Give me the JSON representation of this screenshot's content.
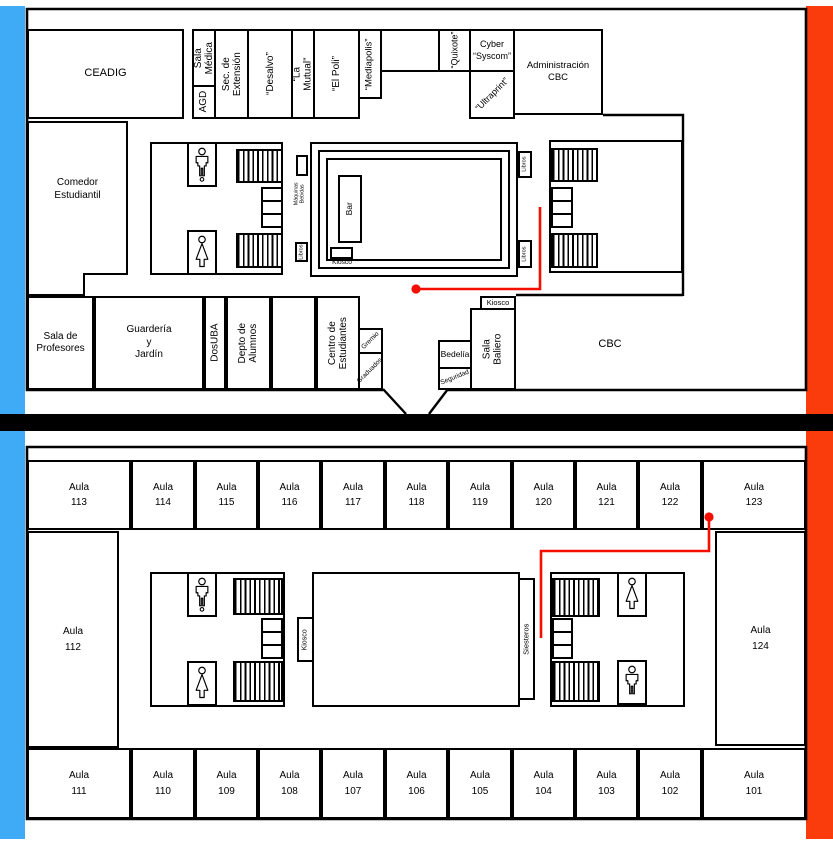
{
  "colors": {
    "blue_stripe": "#3FABF7",
    "orange_stripe": "#FA3C0C",
    "route_red": "#F30F00",
    "wall": "#000000"
  },
  "upper": {
    "top_row": {
      "ceadig": "CEADIG",
      "sala_medica": "Sala\nMédica",
      "agd": "AGD",
      "sec_extension": "Sec. de\nExtensión",
      "desalvo": "“Desalvo”",
      "la_mutual": "“La Mutual”",
      "el_poli": "“El Poli”",
      "mediapolis": "“Mediapolis”",
      "quixote": "“Quixote”",
      "cyber_syscom": "Cyber\n“Syscom”",
      "ultraprint": "“Ultraprint”",
      "administracion_cbc": "Administración\nCBC"
    },
    "left": {
      "comedor": "Comedor\nEstudiantil"
    },
    "bottom_row": {
      "sala_profesores": "Sala de\nProfesores",
      "guarderia": "Guardería\ny\nJardín",
      "dosuba": "DosUBA",
      "depto_alumnos": "Depto de\nAlumnos",
      "centro_estudiantes": "Centro de\nEstudiantes",
      "gremio": "Gremio",
      "graduados": "Graduados",
      "bedelia": "Bedelía",
      "seguridad": "Seguridad",
      "sala_baliero": "Sala\nBaliero",
      "kiosco": "Kiosco",
      "cbc": "CBC"
    },
    "patio": {
      "bar": "Bar",
      "kiosco": "Kiosco",
      "maquinas_bebidas": "Máquinas\nBebidas",
      "libros": "Libros"
    }
  },
  "lower": {
    "aula_word": "Aula",
    "aulas_top": [
      "113",
      "114",
      "115",
      "116",
      "117",
      "118",
      "119",
      "120",
      "121",
      "122",
      "123"
    ],
    "aulas_bottom": [
      "111",
      "110",
      "109",
      "108",
      "107",
      "106",
      "105",
      "104",
      "103",
      "102",
      "101"
    ],
    "aula_left": "112",
    "aula_right": "124",
    "kiosco": "Kiosco",
    "siesteros": "Siesteros"
  }
}
